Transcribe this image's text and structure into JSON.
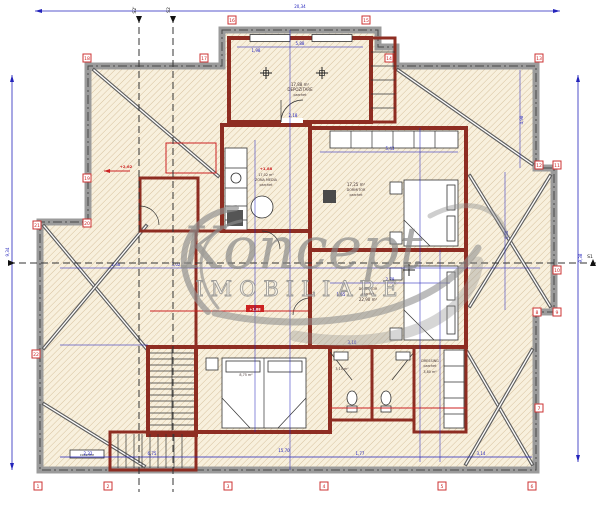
{
  "document": {
    "type": "architectural floor plan",
    "floor": "mansarda"
  },
  "watermark": {
    "brand": "Koncept",
    "subtitle": "IMOBILIARE"
  },
  "sections": {
    "s1": "S1",
    "s2": "S2",
    "s2_prime": "S2'"
  },
  "levels": {
    "zona": "+1,88",
    "corridor": "+1,88",
    "roof_left": "+2,62"
  },
  "rooms": {
    "depozitare": {
      "area": "17,88 m²",
      "name": "DEPOZITARE",
      "finish": "parchet"
    },
    "zona": {
      "area": "17,02 m²",
      "name": "ZONA MEDIA",
      "finish": "parchet"
    },
    "dormitor1": {
      "area": "17,25 m²",
      "name": "DORMITOR",
      "finish": "parchet"
    },
    "dormitor2": {
      "name": "DORMITOR",
      "finish": "parchet",
      "area": "22,90 m²"
    },
    "dormitor3": {
      "area": "8,75 m²"
    },
    "dressing": {
      "name": "DRESSING",
      "finish": "parchet",
      "area": "3,80 m²"
    },
    "baie": {
      "area": "3,10 m²"
    },
    "stairs": {
      "label": "coborare"
    }
  },
  "axis_markers": [
    "1",
    "2",
    "3",
    "4",
    "5",
    "6",
    "7",
    "8",
    "9",
    "10",
    "11",
    "12",
    "13",
    "14",
    "15",
    "16",
    "17",
    "18",
    "19",
    "20",
    "21",
    "22"
  ],
  "dimensions": [
    "20,34",
    "9,34",
    "9,38",
    "5,88",
    "1,98",
    "2,18",
    "5,43",
    "4,98",
    "2,78",
    "1,65",
    "3,10",
    "2,32",
    "6,75",
    "15,70",
    "1,77",
    "3,14",
    "4,46",
    "3,02",
    "2,48"
  ],
  "colors": {
    "wall": "#8e2d22",
    "dimension_blue": "#2323bb",
    "marker_red": "#cc2222",
    "roof_band": "#9b9b9b",
    "parquet_floor": "#f8e2c2",
    "tile_gray": "#e3e3e8",
    "bath_floor": "#dcdcf1",
    "watermark_gray": "#8a8a8a"
  }
}
